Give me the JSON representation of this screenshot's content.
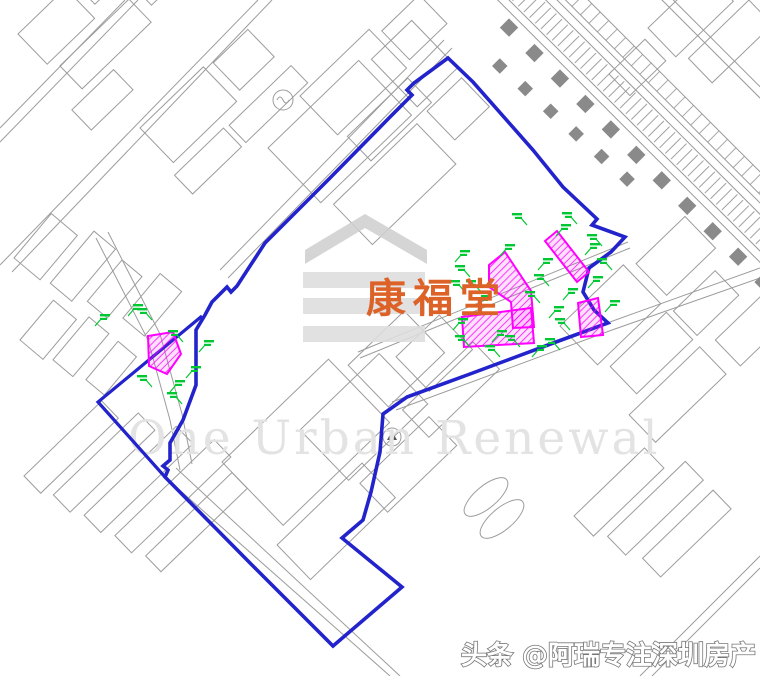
{
  "map": {
    "place_label": "康福堂",
    "watermark_text": "One Urban Renewal",
    "credit_watermark": "头条 @阿瑞专注深圳房产",
    "colors": {
      "boundary_blue": "#2323cc",
      "parcel_magenta": "#ff00ff",
      "marker_green": "#00c832",
      "label_orange": "#dd6227",
      "watermark_gray": "#e3e3e3",
      "logo_gray": "#d7d7d7",
      "linework_gray": "#9c9c9c",
      "road_square_gray": "#8a8a8a",
      "credit_fill": "#ffffff",
      "credit_outline": "#777777"
    },
    "boundary_main": [
      [
        448,
        58
      ],
      [
        473,
        82
      ],
      [
        533,
        150
      ],
      [
        563,
        187
      ],
      [
        597,
        219
      ],
      [
        592,
        225
      ],
      [
        625,
        237
      ],
      [
        611,
        252
      ],
      [
        589,
        268
      ],
      [
        583,
        292
      ],
      [
        594,
        310
      ],
      [
        608,
        323
      ],
      [
        556,
        342
      ],
      [
        470,
        374
      ],
      [
        407,
        397
      ],
      [
        383,
        414
      ],
      [
        380,
        452
      ],
      [
        371,
        492
      ],
      [
        363,
        520
      ],
      [
        342,
        538
      ],
      [
        402,
        587
      ],
      [
        333,
        646
      ],
      [
        250,
        563
      ],
      [
        165,
        477
      ],
      [
        168,
        470
      ],
      [
        163,
        466
      ],
      [
        170,
        460
      ],
      [
        170,
        443
      ],
      [
        183,
        420
      ],
      [
        196,
        385
      ],
      [
        196,
        330
      ],
      [
        205,
        315
      ],
      [
        212,
        302
      ],
      [
        218,
        296
      ],
      [
        227,
        287
      ],
      [
        231,
        292
      ],
      [
        237,
        286
      ],
      [
        265,
        243
      ],
      [
        330,
        178
      ],
      [
        390,
        117
      ],
      [
        412,
        95
      ],
      [
        407,
        90
      ],
      [
        414,
        83
      ],
      [
        448,
        58
      ]
    ],
    "boundary_spur": [
      [
        202,
        316
      ],
      [
        98,
        402
      ],
      [
        165,
        477
      ]
    ],
    "parcels": [
      [
        [
          545,
          241
        ],
        [
          557,
          231
        ],
        [
          589,
          272
        ],
        [
          577,
          282
        ]
      ],
      [
        [
          489,
          265
        ],
        [
          505,
          252
        ],
        [
          531,
          291
        ],
        [
          534,
          327
        ],
        [
          513,
          328
        ],
        [
          511,
          302
        ],
        [
          489,
          287
        ]
      ],
      [
        [
          462,
          317
        ],
        [
          531,
          308
        ],
        [
          534,
          343
        ],
        [
          464,
          347
        ]
      ],
      [
        [
          578,
          303
        ],
        [
          598,
          298
        ],
        [
          603,
          335
        ],
        [
          581,
          337
        ]
      ],
      [
        [
          148,
          336
        ],
        [
          173,
          332
        ],
        [
          181,
          354
        ],
        [
          167,
          374
        ],
        [
          149,
          366
        ]
      ]
    ],
    "survey_markers": [
      [
        128,
        316
      ],
      [
        152,
        320
      ],
      [
        95,
        326
      ],
      [
        183,
        342
      ],
      [
        199,
        352
      ],
      [
        152,
        387
      ],
      [
        170,
        392
      ],
      [
        182,
        404
      ],
      [
        186,
        378
      ],
      [
        527,
        225
      ],
      [
        556,
        236
      ],
      [
        577,
        224
      ],
      [
        455,
        262
      ],
      [
        470,
        277
      ],
      [
        500,
        256
      ],
      [
        481,
        292
      ],
      [
        538,
        270
      ],
      [
        549,
        286
      ],
      [
        563,
        300
      ],
      [
        540,
        303
      ],
      [
        453,
        330
      ],
      [
        470,
        347
      ],
      [
        492,
        342
      ],
      [
        520,
        347
      ],
      [
        549,
        318
      ],
      [
        570,
        330
      ],
      [
        605,
        312
      ],
      [
        612,
        270
      ],
      [
        588,
        288
      ],
      [
        500,
        357
      ],
      [
        532,
        357
      ],
      [
        560,
        350
      ],
      [
        476,
        307
      ],
      [
        465,
        292
      ],
      [
        585,
        255
      ],
      [
        602,
        246
      ]
    ]
  }
}
